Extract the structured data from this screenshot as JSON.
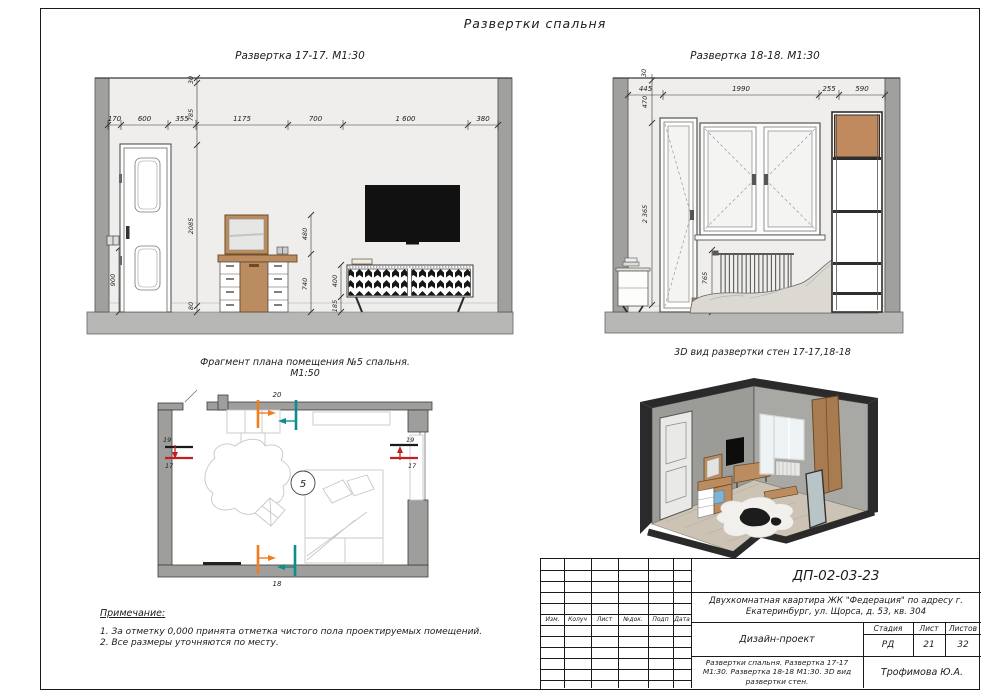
{
  "sheet": {
    "title": "Развертки спальня"
  },
  "colors": {
    "wall_light": "#efeeec",
    "wall_dark": "#a0a09e",
    "floor": "#b7b7b5",
    "wood": "#bb8c5f",
    "tv": "#111111",
    "marker_orange": "#f07d1e",
    "marker_teal": "#0d8e8e",
    "marker_red": "#c41f1f"
  },
  "elev17": {
    "title": "Развертка 17-17. М1:30",
    "top_dims": [
      "170",
      "600",
      "355",
      "1175",
      "700",
      "1 600",
      "380"
    ],
    "left_dims": [
      "30",
      "785",
      "2085",
      "80"
    ],
    "switch_dim": "900",
    "dresser_dims": [
      "480",
      "740"
    ],
    "stand_dims": [
      "400",
      "185"
    ]
  },
  "elev18": {
    "title": "Развертка 18-18. М1:30",
    "top_dims": [
      "445",
      "1990",
      "255",
      "590"
    ],
    "ceiling_dim": "30",
    "left_dims": [
      "470",
      "2 365"
    ],
    "radiator_dims": [
      "765",
      "80"
    ]
  },
  "plan": {
    "title": "Фрагмент плана помещения №5 спальня.",
    "scale": "М1:50",
    "room_number": "5",
    "marker_top": "20",
    "marker_bottom": "18",
    "marker_left_red": "19",
    "marker_left_black": "17",
    "marker_right_red": "19",
    "marker_right_black": "17"
  },
  "view3d": {
    "title": "3D вид развертки стен 17-17,18-18"
  },
  "notes": {
    "heading": "Примечание:",
    "items": [
      "1. За отметку 0,000 принята отметка чистого пола проектируемых помещений.",
      "2. Все размеры уточняются по месту."
    ]
  },
  "titleblock": {
    "doc_code": "ДП-02-03-23",
    "project_line1": "Двухкомнатная квартира ЖК \"Федерация\" по адресу г.",
    "project_line2": "Екатеринбург, ул. Щорса, д. 53, кв. 304",
    "row_labels": [
      "Изм.",
      "Колуч",
      "Лист",
      "№док.",
      "Подп",
      "Дата"
    ],
    "stage_label": "Стадия",
    "sheet_label": "Лист",
    "sheets_label": "Листов",
    "doc_type": "Дизайн-проект",
    "stage_value": "РД",
    "sheet_value": "21",
    "sheets_value": "32",
    "content_line1": "Развертки спальня. Развертка 17-17",
    "content_line2": "М1:30. Развертка 18-18 М1:30. 3D вид",
    "content_line3": "развертки стен.",
    "author": "Трофимова Ю.А."
  }
}
